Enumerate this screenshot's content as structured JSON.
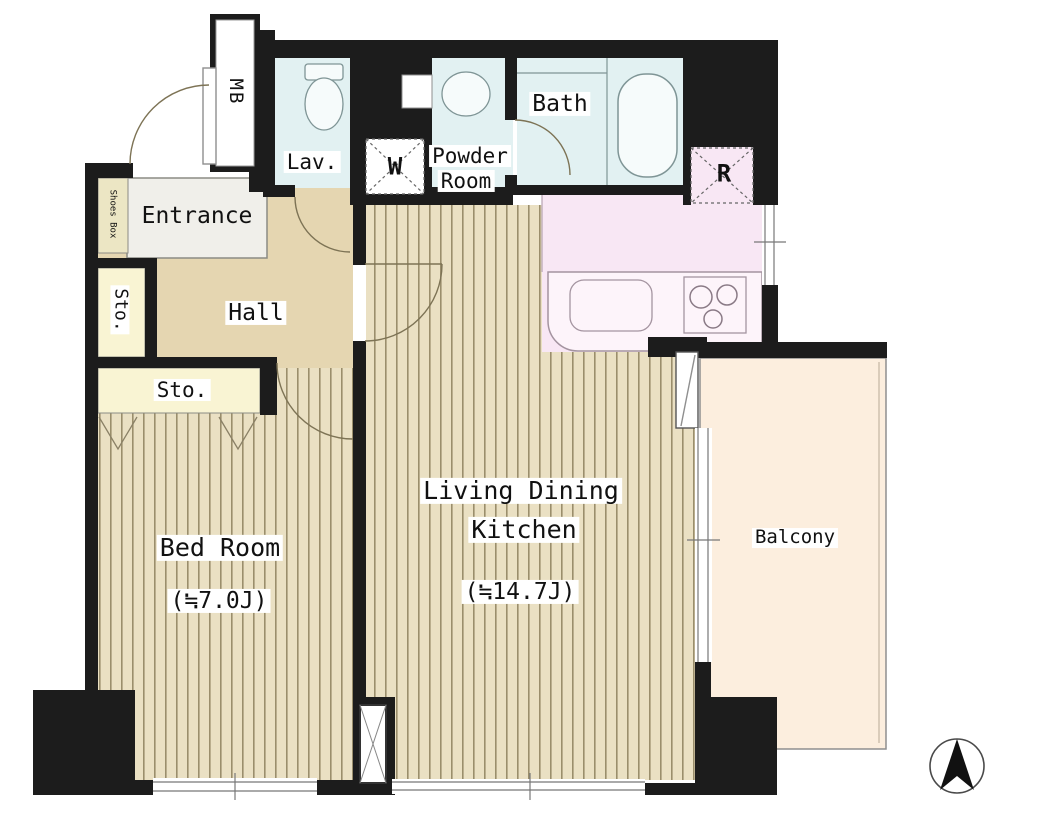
{
  "plan": {
    "type": "apartment-floor-plan",
    "labels": {
      "mb": "MB",
      "lav": "Lav.",
      "powder_line1": "Powder",
      "powder_line2": "Room",
      "washer": "W",
      "bath": "Bath",
      "refrigerator": "R",
      "entrance": "Entrance",
      "shoes_box": "Shoes Box",
      "storage_upper": "Sto.",
      "hall": "Hall",
      "storage_lower": "Sto.",
      "bedroom": "Bed Room",
      "bedroom_size": "(≒7.0J)",
      "ldk_line1": "Living Dining",
      "ldk_line2": "Kitchen",
      "ldk_size": "(≒14.7J)",
      "balcony": "Balcony"
    },
    "colors": {
      "wall": "#1c1c1c",
      "wood_floor": "#eae0c3",
      "wood_stripe": "#9a8e6c",
      "hall_floor": "#e5d6b1",
      "entrance_floor": "#f0efea",
      "storage_fill": "#f9f4d3",
      "shoes_box_fill": "#ece6c4",
      "wet_area_fill": "#e2f1f2",
      "kitchen_fill": "#f8e7f4",
      "counter_fill": "#fdf4fa",
      "balcony_fill": "#fceede"
    },
    "compass": {
      "icon": "north-arrow",
      "points": "up"
    }
  }
}
